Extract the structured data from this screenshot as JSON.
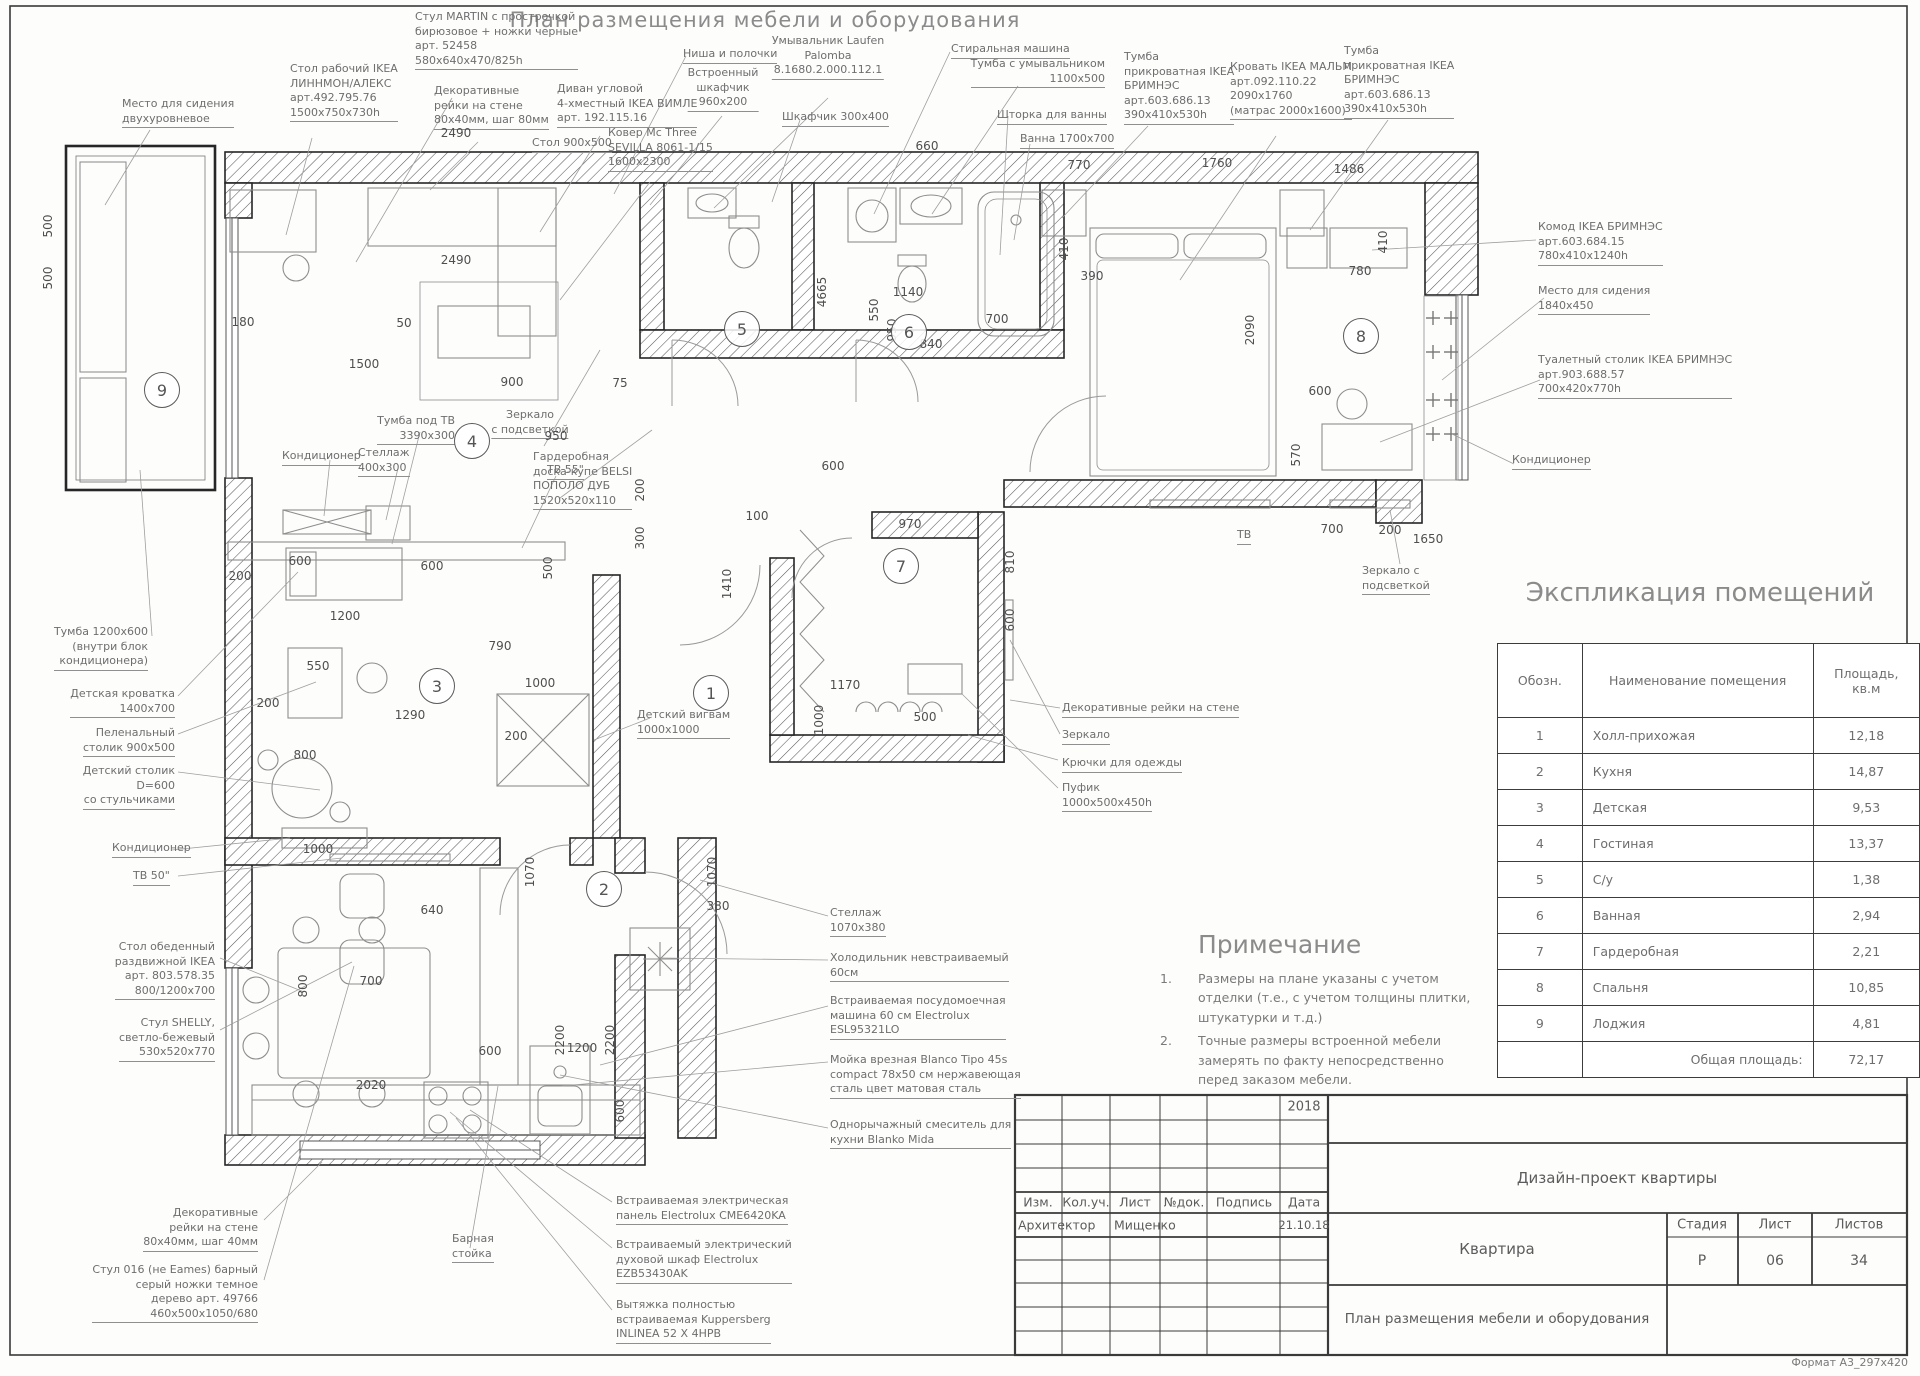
{
  "doc": {
    "title": "План размещения мебели и оборудования",
    "format_note": "Формат А3_297x420"
  },
  "explication": {
    "title": "Экспликация помещений",
    "headers": [
      "Обозн.",
      "Наименование помещения",
      "Площадь, кв.м"
    ],
    "rows": [
      [
        "1",
        "Холл-прихожая",
        "12,18"
      ],
      [
        "2",
        "Кухня",
        "14,87"
      ],
      [
        "3",
        "Детская",
        "9,53"
      ],
      [
        "4",
        "Гостиная",
        "13,37"
      ],
      [
        "5",
        "С/у",
        "1,38"
      ],
      [
        "6",
        "Ванная",
        "2,94"
      ],
      [
        "7",
        "Гардеробная",
        "2,21"
      ],
      [
        "8",
        "Спальня",
        "10,85"
      ],
      [
        "9",
        "Лоджия",
        "4,81"
      ]
    ],
    "total_label": "Общая площадь:",
    "total_value": "72,17"
  },
  "notes": {
    "title": "Примечание",
    "items": [
      "Размеры на плане указаны с учетом отделки (т.е., с учетом толщины плитки, штукатурки и т.д.)",
      "Точные размеры встроенной мебели замерять по факту непосредственно перед заказом мебели."
    ]
  },
  "stamp": {
    "year": "2018",
    "headers": [
      "Изм.",
      "Кол.уч.",
      "Лист",
      "№док.",
      "Подпись",
      "Дата"
    ],
    "role": "Архитектор",
    "name": "Мищенко",
    "date": "21.10.18",
    "project": "Дизайн-проект квартиры",
    "object": "Квартира",
    "stage_label": "Стадия",
    "sheet_label": "Лист",
    "sheets_label": "Листов",
    "stage": "Р",
    "sheet": "06",
    "sheets": "34",
    "drawing_name": "План размещения мебели и оборудования"
  },
  "rooms": [
    {
      "n": "1",
      "x": 711,
      "y": 693
    },
    {
      "n": "2",
      "x": 604,
      "y": 889
    },
    {
      "n": "3",
      "x": 437,
      "y": 686
    },
    {
      "n": "4",
      "x": 472,
      "y": 441
    },
    {
      "n": "5",
      "x": 742,
      "y": 329
    },
    {
      "n": "6",
      "x": 909,
      "y": 332
    },
    {
      "n": "7",
      "x": 901,
      "y": 566
    },
    {
      "n": "8",
      "x": 1361,
      "y": 336
    },
    {
      "n": "9",
      "x": 162,
      "y": 390
    }
  ],
  "annotations": [
    {
      "x": 122,
      "y": 97,
      "a": "l",
      "u": true,
      "ls": [
        "Место для сидения",
        "двухуровневое"
      ]
    },
    {
      "x": 290,
      "y": 62,
      "a": "l",
      "u": true,
      "ls": [
        "Стол рабочий IKEA",
        "ЛИННМОН/АЛЕКС",
        "арт.492.795.76",
        "1500x750x730h"
      ]
    },
    {
      "x": 415,
      "y": 10,
      "a": "l",
      "u": true,
      "ls": [
        "Стул MARTIN с прострочкой",
        "бирюзовое + ножки черные",
        "арт. 52458",
        "580x640x470/825h"
      ]
    },
    {
      "x": 434,
      "y": 84,
      "a": "l",
      "u": true,
      "ls": [
        "Декоративные",
        "рейки на стене",
        "80x40мм, шаг 80мм"
      ]
    },
    {
      "x": 557,
      "y": 82,
      "a": "l",
      "u": true,
      "ls": [
        "Диван угловой",
        "4-хместный IKEA ВИМЛЕ",
        "арт. 192.115.16"
      ]
    },
    {
      "x": 608,
      "y": 126,
      "a": "l",
      "u": true,
      "ls": [
        "Ковер Mc Three",
        "SEVILLA 8061-1/15",
        "1600x2300"
      ]
    },
    {
      "x": 532,
      "y": 136,
      "a": "l",
      "u": true,
      "ls": [
        "Стол 900x500"
      ]
    },
    {
      "x": 683,
      "y": 47,
      "a": "l",
      "u": true,
      "ls": [
        "Ниша и полочки"
      ]
    },
    {
      "x": 723,
      "y": 66,
      "a": "c",
      "u": true,
      "ls": [
        "Встроенный",
        "шкафчик",
        "960x200"
      ]
    },
    {
      "x": 828,
      "y": 34,
      "a": "c",
      "u": true,
      "ls": [
        "Умывальник Laufen",
        "Palomba",
        "8.1680.2.000.112.1"
      ]
    },
    {
      "x": 782,
      "y": 110,
      "a": "l",
      "u": true,
      "ls": [
        "Шкафчик 300x400"
      ]
    },
    {
      "x": 951,
      "y": 42,
      "a": "l",
      "u": true,
      "ls": [
        "Стиральная машина"
      ]
    },
    {
      "x": 1105,
      "y": 57,
      "a": "r",
      "u": true,
      "ls": [
        "Тумба с умывальником",
        "1100x500"
      ]
    },
    {
      "x": 997,
      "y": 108,
      "a": "l",
      "u": true,
      "ls": [
        "Шторка для ванны"
      ]
    },
    {
      "x": 1020,
      "y": 132,
      "a": "l",
      "u": true,
      "ls": [
        "Ванна 1700x700"
      ]
    },
    {
      "x": 1124,
      "y": 50,
      "a": "l",
      "u": true,
      "ls": [
        "Тумба",
        "прикроватная IKEA",
        "БРИМНЭС",
        "арт.603.686.13",
        "390x410x530h"
      ]
    },
    {
      "x": 1230,
      "y": 60,
      "a": "l",
      "u": true,
      "ls": [
        "Кровать IKEA МАЛЬМ",
        "арт.092.110.22",
        "2090x1760",
        "(матрас 2000x1600)"
      ]
    },
    {
      "x": 1344,
      "y": 44,
      "a": "l",
      "u": true,
      "ls": [
        "Тумба",
        "прикроватная IKEA",
        "БРИМНЭС",
        "арт.603.686.13",
        "390x410x530h"
      ]
    },
    {
      "x": 1538,
      "y": 220,
      "a": "l",
      "u": true,
      "ls": [
        "Комод IKEA БРИМНЭС",
        "арт.603.684.15",
        "780x410x1240h"
      ]
    },
    {
      "x": 1538,
      "y": 284,
      "a": "l",
      "u": true,
      "ls": [
        "Место для сидения",
        "1840x450"
      ]
    },
    {
      "x": 1538,
      "y": 353,
      "a": "l",
      "u": true,
      "ls": [
        "Туалетный столик IKEA БРИМНЭС",
        "арт.903.688.57",
        "700x420x770h"
      ]
    },
    {
      "x": 1512,
      "y": 453,
      "a": "l",
      "u": true,
      "ls": [
        "Кондиционер"
      ]
    },
    {
      "x": 1362,
      "y": 564,
      "a": "l",
      "u": true,
      "ls": [
        "Зеркало с",
        "подсветкой"
      ]
    },
    {
      "x": 530,
      "y": 408,
      "a": "c",
      "u": true,
      "ls": [
        "Зеркало",
        "с подсветкой"
      ]
    },
    {
      "x": 533,
      "y": 450,
      "a": "l",
      "u": true,
      "ls": [
        "Гардеробная",
        "доска-купе BELSI",
        "ПОПОЛО ДУБ",
        "1520x520x110"
      ]
    },
    {
      "x": 455,
      "y": 414,
      "a": "r",
      "u": true,
      "ls": [
        "Тумба под ТВ",
        "3390x300"
      ]
    },
    {
      "x": 282,
      "y": 449,
      "a": "l",
      "u": true,
      "ls": [
        "Кондиционер"
      ]
    },
    {
      "x": 358,
      "y": 446,
      "a": "l",
      "u": true,
      "ls": [
        "Стеллаж",
        "400x300"
      ]
    },
    {
      "x": 547,
      "y": 463,
      "a": "l",
      "u": true,
      "ls": [
        "ТВ 55\""
      ]
    },
    {
      "x": 148,
      "y": 625,
      "a": "r",
      "u": true,
      "ls": [
        "Тумба 1200x600",
        "(внутри блок",
        "кондиционера)"
      ]
    },
    {
      "x": 175,
      "y": 687,
      "a": "r",
      "u": true,
      "ls": [
        "Детская кроватка",
        "1400x700"
      ]
    },
    {
      "x": 175,
      "y": 726,
      "a": "r",
      "u": true,
      "ls": [
        "Пеленальный",
        "столик 900x500"
      ]
    },
    {
      "x": 175,
      "y": 764,
      "a": "r",
      "u": true,
      "ls": [
        "Детский столик",
        "D=600",
        "со стульчиками"
      ]
    },
    {
      "x": 112,
      "y": 841,
      "a": "l",
      "u": true,
      "ls": [
        "Кондиционер"
      ]
    },
    {
      "x": 133,
      "y": 869,
      "a": "l",
      "u": true,
      "ls": [
        "ТВ 50\""
      ]
    },
    {
      "x": 637,
      "y": 708,
      "a": "l",
      "u": true,
      "ls": [
        "Детский вигвам",
        "1000x1000"
      ]
    },
    {
      "x": 1062,
      "y": 701,
      "a": "l",
      "u": true,
      "ls": [
        "Декоративные рейки на стене"
      ]
    },
    {
      "x": 1062,
      "y": 728,
      "a": "l",
      "u": true,
      "ls": [
        "Зеркало"
      ]
    },
    {
      "x": 1062,
      "y": 756,
      "a": "l",
      "u": true,
      "ls": [
        "Крючки для одежды"
      ]
    },
    {
      "x": 1062,
      "y": 781,
      "a": "l",
      "u": true,
      "ls": [
        "Пуфик",
        "1000x500x450h"
      ]
    },
    {
      "x": 830,
      "y": 906,
      "a": "l",
      "u": true,
      "ls": [
        "Стеллаж",
        "1070x380"
      ]
    },
    {
      "x": 830,
      "y": 951,
      "a": "l",
      "u": true,
      "ls": [
        "Холодильник невстраиваемый",
        "60см"
      ]
    },
    {
      "x": 830,
      "y": 994,
      "a": "l",
      "u": true,
      "ls": [
        "Встраиваемая посудомоечная",
        "машина 60 см Electrolux",
        "ESL95321LO"
      ]
    },
    {
      "x": 830,
      "y": 1053,
      "a": "l",
      "u": true,
      "ls": [
        "Мойка врезная Blanco Tipo 45s",
        "compact 78x50 см нержавеющая",
        "сталь цвет матовая сталь"
      ]
    },
    {
      "x": 830,
      "y": 1118,
      "a": "l",
      "u": true,
      "ls": [
        "Однорычажный смеситель для",
        "кухни Blanko Mida"
      ]
    },
    {
      "x": 616,
      "y": 1194,
      "a": "l",
      "u": true,
      "ls": [
        "Встраиваемая электрическая",
        "панель Electrolux CME6420KA"
      ]
    },
    {
      "x": 616,
      "y": 1238,
      "a": "l",
      "u": true,
      "ls": [
        "Встраиваемый электрический",
        "духовой шкаф Electrolux",
        "EZB53430AK"
      ]
    },
    {
      "x": 616,
      "y": 1298,
      "a": "l",
      "u": true,
      "ls": [
        "Вытяжка полностью",
        "встраиваемая Kuppersberg",
        "INLINEA 52 X 4HPB"
      ]
    },
    {
      "x": 215,
      "y": 940,
      "a": "r",
      "u": true,
      "ls": [
        "Стол обеденный",
        "раздвижной IKEA",
        "арт. 803.578.35",
        "800/1200x700"
      ]
    },
    {
      "x": 215,
      "y": 1016,
      "a": "r",
      "u": true,
      "ls": [
        "Стул SHELLY,",
        "светло-бежевый",
        "530x520x770"
      ]
    },
    {
      "x": 258,
      "y": 1206,
      "a": "r",
      "u": true,
      "ls": [
        "Декоративные",
        "рейки на стене",
        "80x40мм, шаг 40мм"
      ]
    },
    {
      "x": 258,
      "y": 1263,
      "a": "r",
      "u": true,
      "ls": [
        "Стул 016 (не Eames) барный",
        "серый ножки темное",
        "дерево арт. 49766",
        "460x500x1050/680"
      ]
    },
    {
      "x": 452,
      "y": 1232,
      "a": "l",
      "u": true,
      "ls": [
        "Барная",
        "стойка"
      ]
    },
    {
      "x": 1237,
      "y": 528,
      "a": "l",
      "u": true,
      "ls": [
        "ТВ"
      ]
    }
  ],
  "dims": [
    {
      "t": "2490",
      "x": 456,
      "y": 140
    },
    {
      "t": "660",
      "x": 927,
      "y": 153
    },
    {
      "t": "770",
      "x": 1079,
      "y": 172
    },
    {
      "t": "1760",
      "x": 1217,
      "y": 170
    },
    {
      "t": "1486",
      "x": 1349,
      "y": 176
    },
    {
      "t": "500",
      "x": 48,
      "y": 226,
      "v": 1
    },
    {
      "t": "500",
      "x": 48,
      "y": 278,
      "v": 1
    },
    {
      "t": "180",
      "x": 243,
      "y": 329
    },
    {
      "t": "1500",
      "x": 364,
      "y": 371
    },
    {
      "t": "50",
      "x": 404,
      "y": 330
    },
    {
      "t": "900",
      "x": 512,
      "y": 389
    },
    {
      "t": "2490",
      "x": 456,
      "y": 267
    },
    {
      "t": "75",
      "x": 620,
      "y": 390
    },
    {
      "t": "4665",
      "x": 822,
      "y": 292,
      "v": 1
    },
    {
      "t": "550",
      "x": 874,
      "y": 310,
      "v": 1
    },
    {
      "t": "950",
      "x": 892,
      "y": 330,
      "v": 1
    },
    {
      "t": "1140",
      "x": 908,
      "y": 299
    },
    {
      "t": "840",
      "x": 931,
      "y": 351
    },
    {
      "t": "700",
      "x": 997,
      "y": 326
    },
    {
      "t": "390",
      "x": 1092,
      "y": 283
    },
    {
      "t": "410",
      "x": 1064,
      "y": 249,
      "v": 1
    },
    {
      "t": "2090",
      "x": 1250,
      "y": 330,
      "v": 1
    },
    {
      "t": "780",
      "x": 1360,
      "y": 278
    },
    {
      "t": "410",
      "x": 1383,
      "y": 242,
      "v": 1
    },
    {
      "t": "600",
      "x": 1320,
      "y": 398
    },
    {
      "t": "570",
      "x": 1296,
      "y": 455,
      "v": 1
    },
    {
      "t": "1650",
      "x": 1428,
      "y": 546
    },
    {
      "t": "700",
      "x": 1332,
      "y": 536
    },
    {
      "t": "200",
      "x": 1390,
      "y": 537
    },
    {
      "t": "950",
      "x": 556,
      "y": 443
    },
    {
      "t": "200",
      "x": 640,
      "y": 490,
      "v": 1
    },
    {
      "t": "300",
      "x": 640,
      "y": 538,
      "v": 1
    },
    {
      "t": "100",
      "x": 757,
      "y": 523
    },
    {
      "t": "600",
      "x": 833,
      "y": 473
    },
    {
      "t": "970",
      "x": 910,
      "y": 531
    },
    {
      "t": "810",
      "x": 1010,
      "y": 562,
      "v": 1
    },
    {
      "t": "600",
      "x": 1010,
      "y": 620,
      "v": 1
    },
    {
      "t": "1410",
      "x": 727,
      "y": 584,
      "v": 1
    },
    {
      "t": "600",
      "x": 300,
      "y": 568
    },
    {
      "t": "600",
      "x": 432,
      "y": 573
    },
    {
      "t": "500",
      "x": 548,
      "y": 568,
      "v": 1
    },
    {
      "t": "200",
      "x": 240,
      "y": 583
    },
    {
      "t": "1200",
      "x": 345,
      "y": 623
    },
    {
      "t": "790",
      "x": 500,
      "y": 653
    },
    {
      "t": "550",
      "x": 318,
      "y": 673
    },
    {
      "t": "1000",
      "x": 540,
      "y": 690
    },
    {
      "t": "1290",
      "x": 410,
      "y": 722
    },
    {
      "t": "200",
      "x": 268,
      "y": 710
    },
    {
      "t": "200",
      "x": 516,
      "y": 743
    },
    {
      "t": "800",
      "x": 305,
      "y": 762
    },
    {
      "t": "1170",
      "x": 845,
      "y": 692
    },
    {
      "t": "1000",
      "x": 819,
      "y": 720,
      "v": 1
    },
    {
      "t": "500",
      "x": 925,
      "y": 724
    },
    {
      "t": "1070",
      "x": 530,
      "y": 872,
      "v": 1
    },
    {
      "t": "1070",
      "x": 712,
      "y": 872,
      "v": 1
    },
    {
      "t": "380",
      "x": 718,
      "y": 913
    },
    {
      "t": "640",
      "x": 432,
      "y": 917
    },
    {
      "t": "1000",
      "x": 318,
      "y": 856
    },
    {
      "t": "700",
      "x": 371,
      "y": 988
    },
    {
      "t": "800",
      "x": 303,
      "y": 986,
      "v": 1
    },
    {
      "t": "600",
      "x": 490,
      "y": 1058
    },
    {
      "t": "2200",
      "x": 560,
      "y": 1040,
      "v": 1
    },
    {
      "t": "1200",
      "x": 582,
      "y": 1055
    },
    {
      "t": "2200",
      "x": 610,
      "y": 1040,
      "v": 1
    },
    {
      "t": "600",
      "x": 620,
      "y": 1111,
      "v": 1
    },
    {
      "t": "2020",
      "x": 371,
      "y": 1092
    }
  ]
}
